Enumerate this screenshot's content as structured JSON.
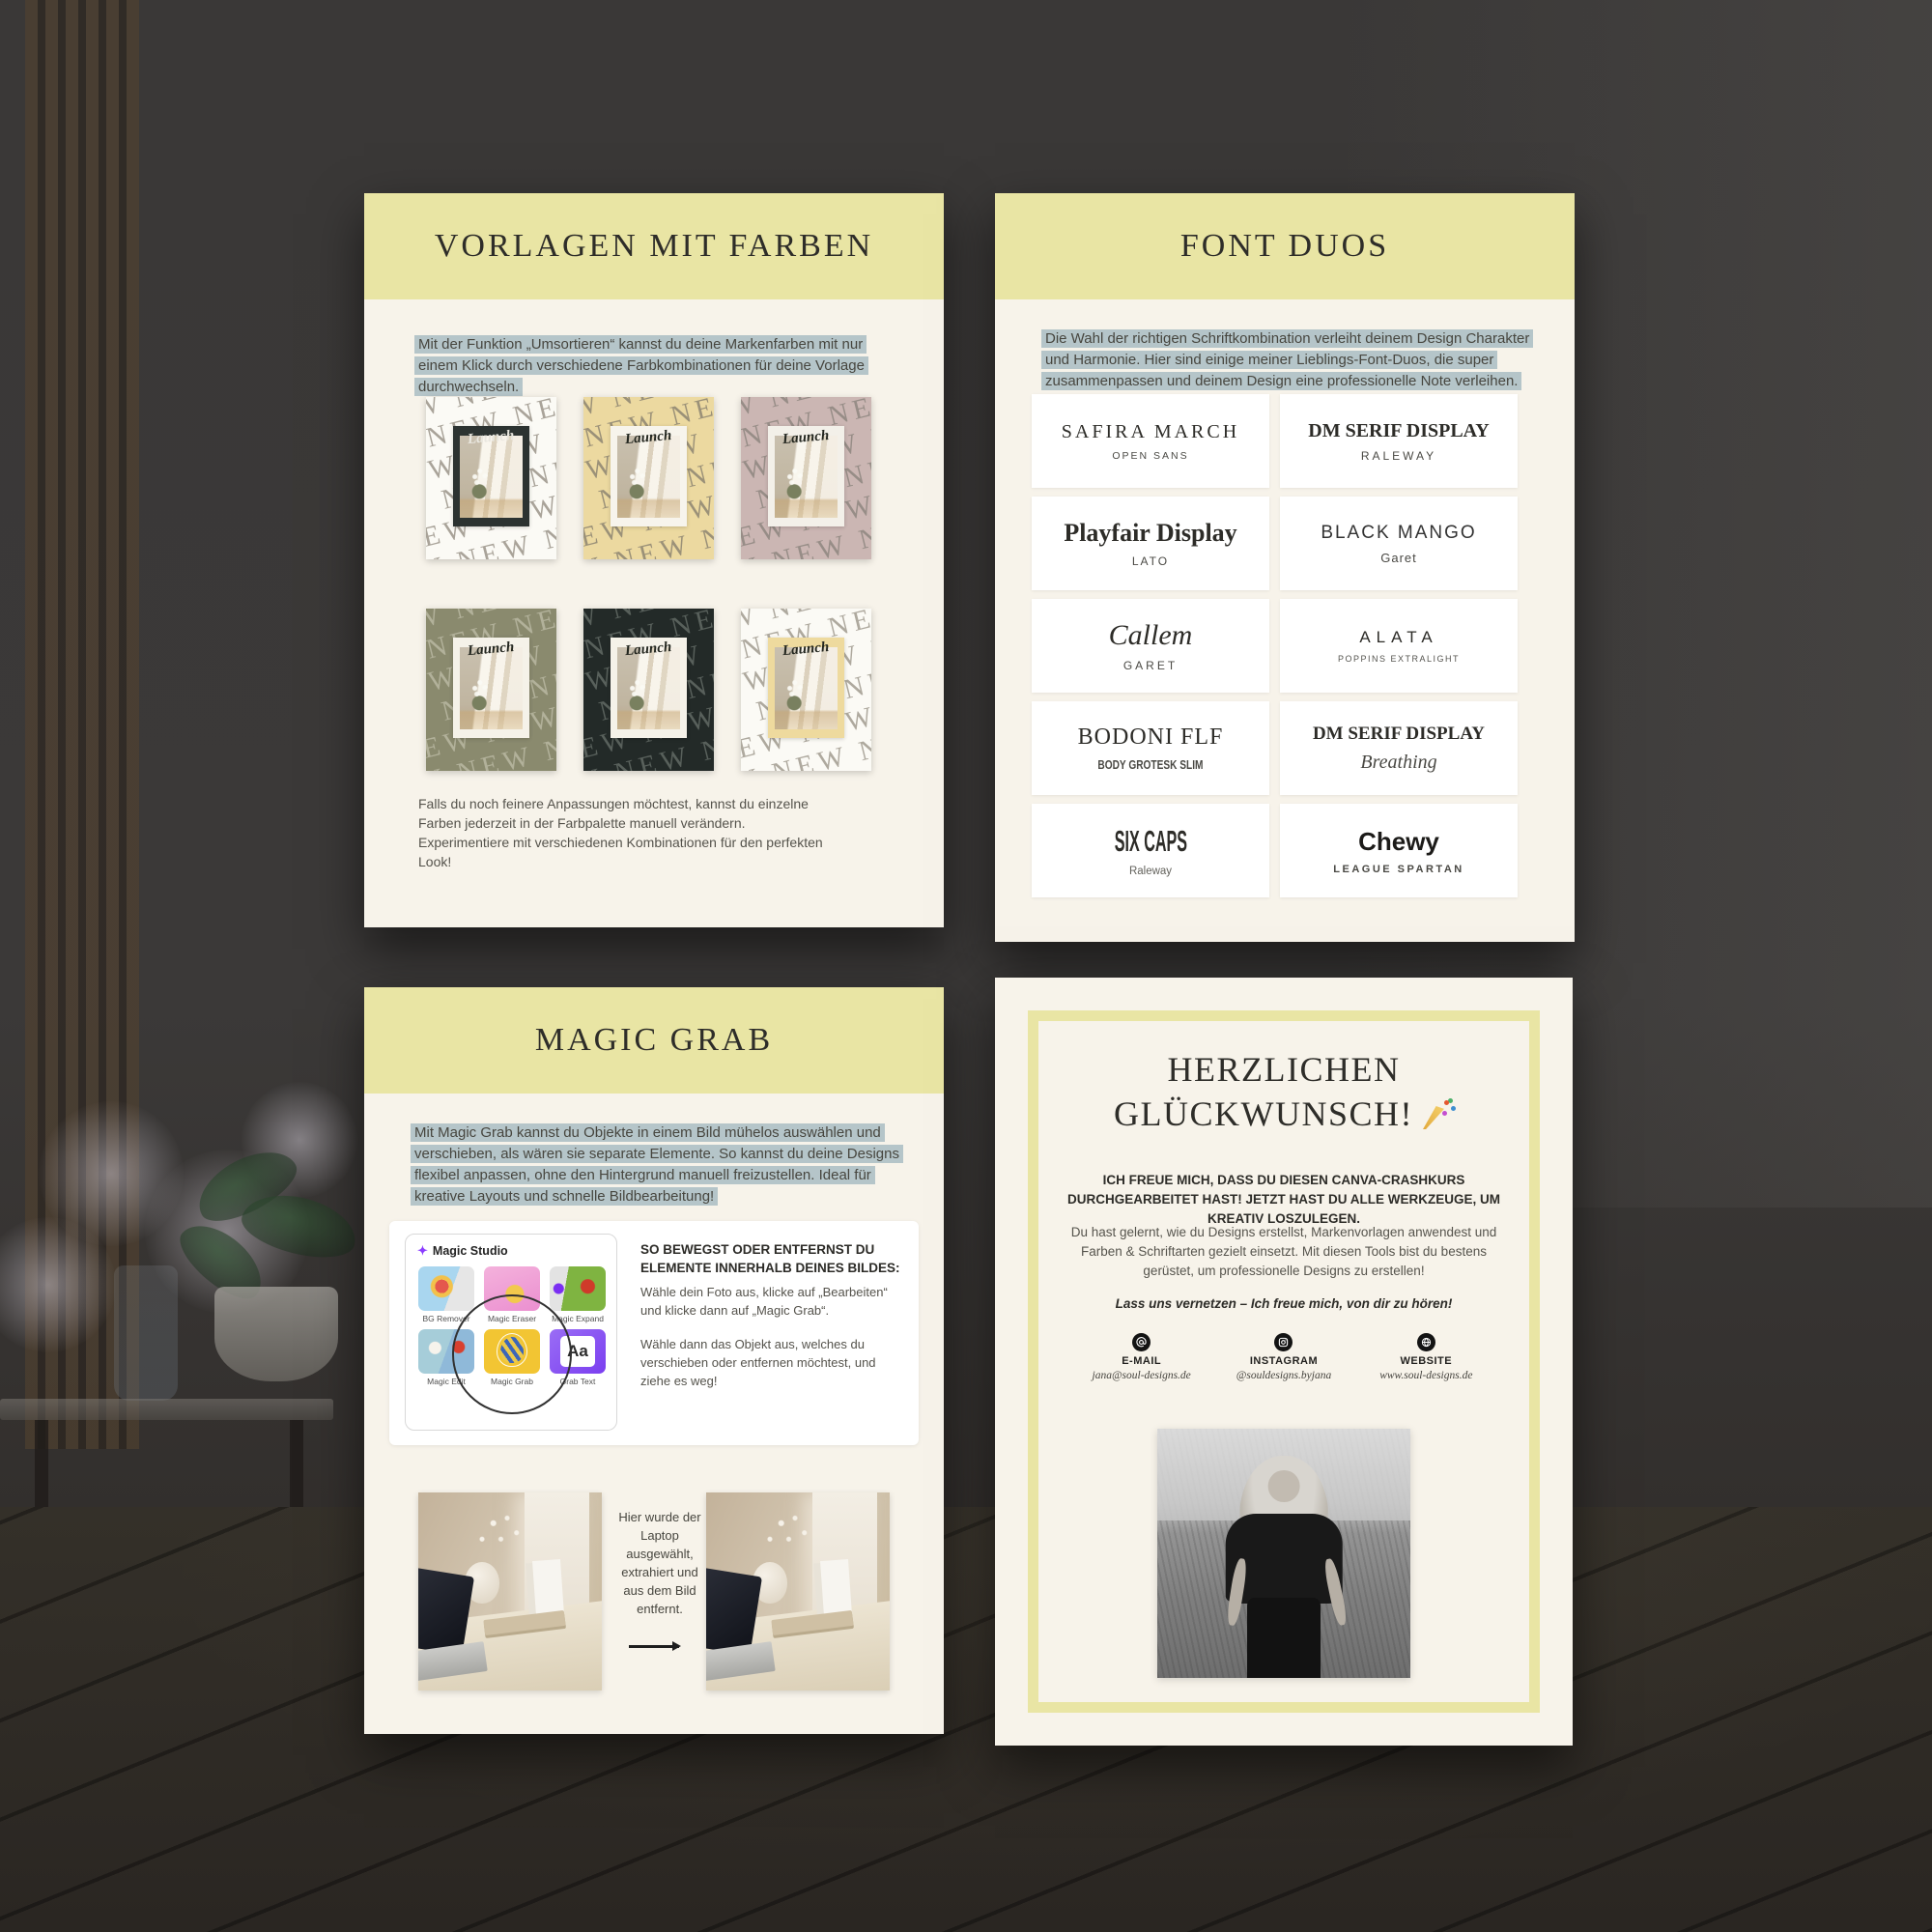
{
  "scene": {
    "description": "Four cream course pages pinned over a dark interior room mockup with wood slats, flowers and a wooden floor"
  },
  "colors": {
    "page_bg": "#f7f3ea",
    "band_yellow": "#e9e5a4",
    "highlight_blue": "#b5c5c9",
    "card_white": "#ffffff",
    "title_ink": "#2e2d29"
  },
  "page1": {
    "title": "VORLAGEN MIT FARBEN",
    "intro": "Mit der Funktion „Umsortieren“ kannst du deine Markenfarben mit nur einem Klick durch verschiedene Farbkombinationen für deine Vorlage durchwechseln.",
    "pattern_word": "NEW",
    "badge": "Launch",
    "templates": [
      {
        "name": "template-white-dark-frame",
        "bg": "#fbfaf5",
        "pattern": "#9b958a",
        "frame": "#2c3331",
        "ink": "#e9e7df"
      },
      {
        "name": "template-yellow-white-frame",
        "bg": "#ecd9a0",
        "pattern": "#8d8572",
        "frame": "#f7f4ec",
        "ink": "#23261f"
      },
      {
        "name": "template-mauve-white-frame",
        "bg": "#cbb6b3",
        "pattern": "#8f8780",
        "frame": "#f3f0e9",
        "ink": "#23261f"
      },
      {
        "name": "template-olive-white-frame",
        "bg": "#8a8a6e",
        "pattern": "#b9b8a2",
        "frame": "#f5f2e9",
        "ink": "#23261f"
      },
      {
        "name": "template-dark-white-frame",
        "bg": "#232a28",
        "pattern": "#626a65",
        "frame": "#f5f2e9",
        "ink": "#23261f"
      },
      {
        "name": "template-white-yellow-frame",
        "bg": "#fbfaf5",
        "pattern": "#a19b90",
        "frame": "#eeda9e",
        "ink": "#23261f"
      }
    ],
    "outro": "Falls du noch feinere Anpassungen möchtest, kannst du einzelne Farben jederzeit in der Farbpalette manuell verändern. Experimentiere mit verschiedenen Kombinationen für den perfekten Look!"
  },
  "page2": {
    "title": "FONT DUOS",
    "intro": "Die Wahl der richtigen Schriftkombination verleiht deinem Design Charakter und Harmonie. Hier sind einige meiner Lieblings-Font-Duos, die super zusammenpassen und deinem Design eine professionelle Note verleihen.",
    "duos": [
      {
        "primary": "SAFIRA MARCH",
        "secondary": "OPEN SANS"
      },
      {
        "primary": "DM SERIF DISPLAY",
        "secondary": "RALEWAY"
      },
      {
        "primary": "Playfair Display",
        "secondary": "LATO"
      },
      {
        "primary": "BLACK MANGO",
        "secondary": "Garet"
      },
      {
        "primary": "Callem",
        "secondary": "GARET"
      },
      {
        "primary": "ALATA",
        "secondary": "POPPINS EXTRALIGHT"
      },
      {
        "primary": "BODONI FLF",
        "secondary": "BODY GROTESK SLIM"
      },
      {
        "primary": "DM SERIF DISPLAY",
        "secondary": "Breathing"
      },
      {
        "primary": "SIX CAPS",
        "secondary": "Raleway"
      },
      {
        "primary": "Chewy",
        "secondary": "LEAGUE SPARTAN"
      }
    ]
  },
  "page3": {
    "title": "MAGIC GRAB",
    "intro": "Mit Magic Grab kannst du Objekte in einem Bild mühelos auswählen und verschieben, als wären sie separate Elemente. So kannst du deine Designs flexibel anpassen, ohne den Hintergrund manuell freizustellen. Ideal für kreative Layouts und schnelle Bildbearbeitung!",
    "studio": {
      "header_icon": "sparkle-icon",
      "header": "Magic Studio",
      "tools": [
        "BG Remover",
        "Magic Eraser",
        "Magic Expand",
        "Magic Edit",
        "Magic Grab",
        "Grab Text"
      ],
      "grab_text_sample": "Aa"
    },
    "howto_heading": "SO BEWEGST ODER ENTFERNST DU ELEMENTE INNERHALB DEINES BILDES:",
    "howto_step1": "Wähle dein Foto aus, klicke auf „Bearbeiten“ und klicke dann auf „Magic Grab“.",
    "howto_step2": "Wähle dann das Objekt aus, welches du verschieben oder entfernen möchtest, und ziehe es weg!",
    "caption": "Hier wurde der Laptop ausgewählt, extrahiert und aus dem Bild entfernt.",
    "arrow_icon": "arrow-right-icon"
  },
  "page4": {
    "title_line1": "HERZLICHEN",
    "title_line2": "GLÜCKWUNSCH!",
    "title_icon": "party-popper-icon",
    "lead": "ICH FREUE MICH, DASS DU DIESEN CANVA-CRASHKURS DURCHGEARBEITET HAST! JETZT HAST DU ALLE WERKZEUGE, UM KREATIV LOSZULEGEN.",
    "body": "Du hast gelernt, wie du Designs erstellst, Markenvorlagen anwendest und Farben & Schriftarten gezielt einsetzt. Mit diesen Tools bist du bestens gerüstet, um professionelle Designs zu erstellen!",
    "cta": "Lass uns vernetzen – Ich freue mich, von dir zu hören!",
    "contacts": [
      {
        "icon": "email-icon",
        "label": "E-MAIL",
        "value": "jana@soul-designs.de"
      },
      {
        "icon": "instagram-icon",
        "label": "INSTAGRAM",
        "value": "@souldesigns.byjana"
      },
      {
        "icon": "website-icon",
        "label": "WEBSITE",
        "value": "www.soul-designs.de"
      }
    ],
    "photo": "black-and-white portrait of a woman in a field"
  }
}
